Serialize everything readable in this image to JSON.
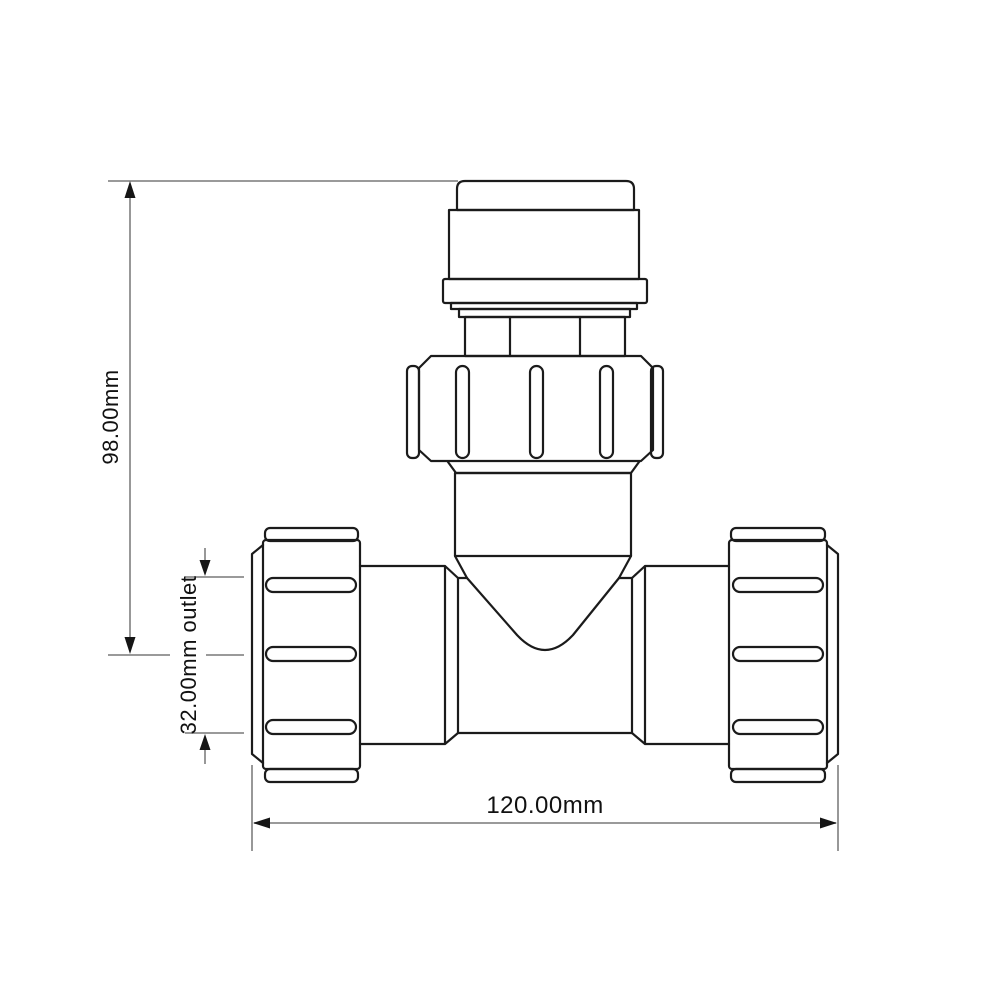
{
  "drawing": {
    "type": "technical-drawing",
    "subject": "tee compression pipe fitting, front elevation"
  },
  "dimensions": {
    "height_label": "98.00mm",
    "outlet_label": "32.00mm outlet",
    "width_label": "120.00mm"
  },
  "colors": {
    "background": "#ffffff",
    "outline": "#1b1b1b",
    "dimension_line": "#8c8c8c",
    "arrow": "#151515",
    "label_text": "#111111"
  }
}
